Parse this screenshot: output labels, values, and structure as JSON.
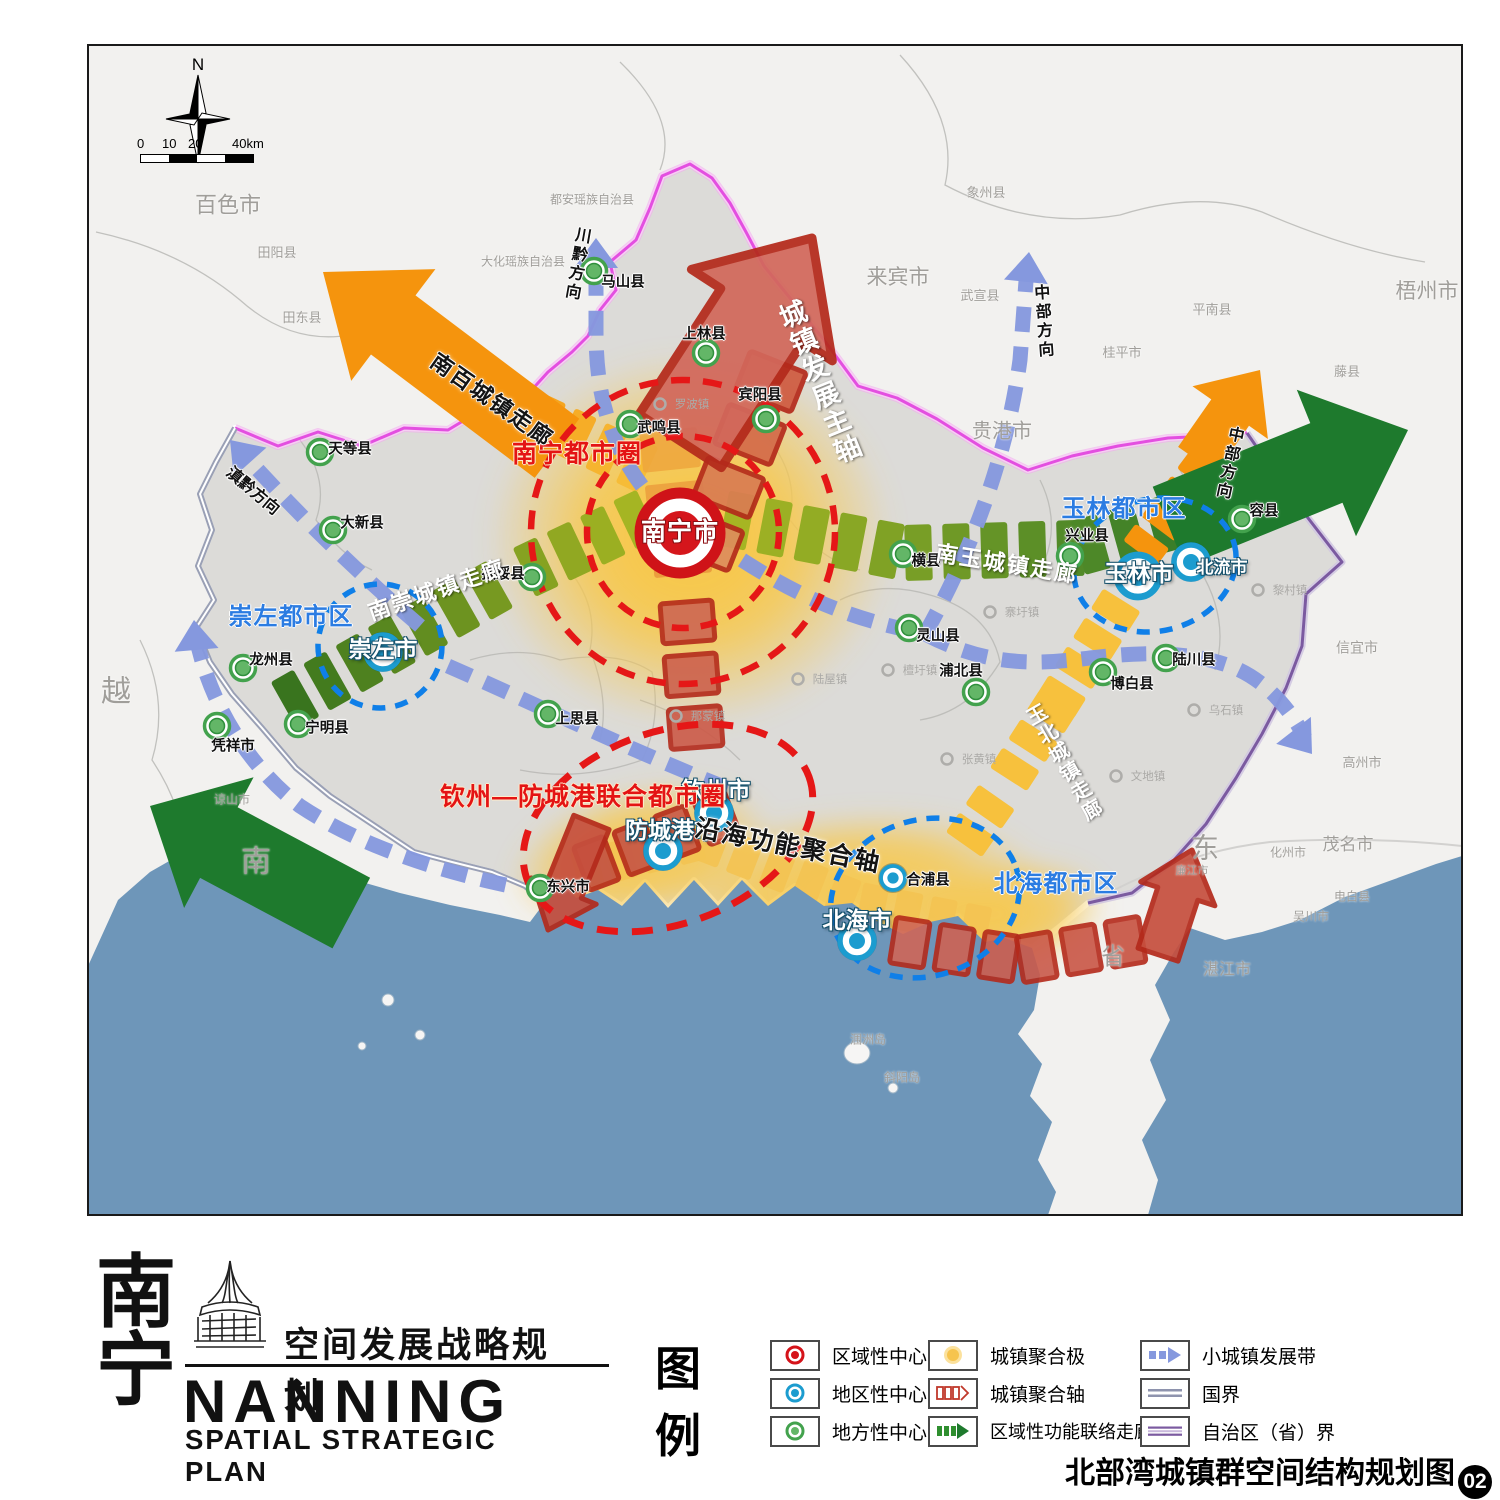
{
  "compass": {
    "label": "N"
  },
  "scalebar": {
    "ticks": [
      "0",
      "10",
      "20",
      "40km"
    ]
  },
  "title": {
    "cn_char_top": "南",
    "cn_char_bottom": "宁",
    "subtitle_cn": "空间发展战略规划",
    "name_en": "NANNING",
    "subtitle_en": "SPATIAL STRATEGIC PLAN"
  },
  "legend": {
    "heading_top": "图",
    "heading_bottom": "例",
    "columns": [
      [
        {
          "icon": "center-regional",
          "label": "区域性中心"
        },
        {
          "icon": "center-district",
          "label": "地区性中心"
        },
        {
          "icon": "center-local",
          "label": "地方性中心"
        }
      ],
      [
        {
          "icon": "agg-pole",
          "label": "城镇聚合极"
        },
        {
          "icon": "agg-axis",
          "label": "城镇聚合轴"
        },
        {
          "icon": "regional-corridor",
          "label": "区域性功能联络走廊"
        }
      ],
      [
        {
          "icon": "town-belt",
          "label": "小城镇发展带"
        },
        {
          "icon": "national-border",
          "label": "国界"
        },
        {
          "icon": "province-border",
          "label": "自治区（省）界"
        }
      ]
    ]
  },
  "caption": {
    "text": "北部湾城镇群空间结构规划图",
    "number": "02"
  },
  "map": {
    "cities": [
      {
        "label": "南宁市",
        "type": "regional",
        "mx": 680,
        "my": 533,
        "lx": 680,
        "ly": 532
      },
      {
        "label": "崇左市",
        "type": "district",
        "mx": 383,
        "my": 652,
        "lx": 383,
        "ly": 649
      },
      {
        "label": "玉林市",
        "type": "district-lg",
        "mx": 1138,
        "my": 576,
        "lx": 1139,
        "ly": 573
      },
      {
        "label": "北流市",
        "type": "district",
        "mx": 1191,
        "my": 562,
        "lx": 1222,
        "ly": 568,
        "lsize": 17
      },
      {
        "label": "钦州市",
        "type": "district",
        "mx": 714,
        "my": 813,
        "lx": 716,
        "ly": 790
      },
      {
        "label": "防城港市",
        "type": "district",
        "mx": 663,
        "my": 851,
        "lx": 671,
        "ly": 830
      },
      {
        "label": "北海市",
        "type": "district",
        "mx": 857,
        "my": 941,
        "lx": 857,
        "ly": 920
      },
      {
        "label": "合浦县",
        "type": "district-sm",
        "mx": 893,
        "my": 878,
        "lx": 928,
        "ly": 881
      }
    ],
    "locals": [
      {
        "label": "天等县",
        "mx": 320,
        "my": 452,
        "lx": 350,
        "ly": 450
      },
      {
        "label": "大新县",
        "mx": 333,
        "my": 530,
        "lx": 362,
        "ly": 524
      },
      {
        "label": "龙州县",
        "mx": 243,
        "my": 668,
        "lx": 271,
        "ly": 661
      },
      {
        "label": "宁明县",
        "mx": 298,
        "my": 724,
        "lx": 327,
        "ly": 729
      },
      {
        "label": "凭祥市",
        "mx": 217,
        "my": 726,
        "lx": 233,
        "ly": 747
      },
      {
        "label": "扶绥县",
        "mx": 532,
        "my": 577,
        "lx": 503,
        "ly": 575
      },
      {
        "label": "上思县",
        "mx": 548,
        "my": 714,
        "lx": 577,
        "ly": 720
      },
      {
        "label": "东兴市",
        "mx": 540,
        "my": 888,
        "lx": 568,
        "ly": 888
      },
      {
        "label": "武鸣县",
        "mx": 630,
        "my": 424,
        "lx": 659,
        "ly": 429
      },
      {
        "label": "马山县",
        "mx": 594,
        "my": 271,
        "lx": 623,
        "ly": 283
      },
      {
        "label": "上林县",
        "mx": 706,
        "my": 353,
        "lx": 704,
        "ly": 335
      },
      {
        "label": "宾阳县",
        "mx": 766,
        "my": 419,
        "lx": 760,
        "ly": 396
      },
      {
        "label": "横县",
        "mx": 903,
        "my": 554,
        "lx": 926,
        "ly": 562
      },
      {
        "label": "灵山县",
        "mx": 909,
        "my": 628,
        "lx": 938,
        "ly": 637
      },
      {
        "label": "浦北县",
        "mx": 976,
        "my": 692,
        "lx": 961,
        "ly": 672
      },
      {
        "label": "博白县",
        "mx": 1103,
        "my": 672,
        "lx": 1132,
        "ly": 685
      },
      {
        "label": "陆川县",
        "mx": 1166,
        "my": 658,
        "lx": 1194,
        "ly": 661
      },
      {
        "label": "兴业县",
        "mx": 1070,
        "my": 556,
        "lx": 1087,
        "ly": 537
      },
      {
        "label": "容县",
        "mx": 1242,
        "my": 519,
        "lx": 1264,
        "ly": 512
      }
    ],
    "metros": [
      {
        "label": "南宁都市圈",
        "x": 577,
        "y": 454,
        "color": "red"
      },
      {
        "label": "钦州—防城港联合都市圈",
        "x": 583,
        "y": 797,
        "color": "red"
      },
      {
        "label": "崇左都市区",
        "x": 291,
        "y": 617,
        "color": "blue"
      },
      {
        "label": "玉林都市区",
        "x": 1124,
        "y": 509,
        "color": "blue"
      },
      {
        "label": "北海都市区",
        "x": 1056,
        "y": 884,
        "color": "blue"
      }
    ],
    "corridors": [
      {
        "label": "南百城镇走廊",
        "x": 492,
        "y": 400,
        "rot": 35,
        "cls": "black",
        "size": 22,
        "vertical": false
      },
      {
        "label": "南崇城镇走廊",
        "x": 437,
        "y": 590,
        "rot": -19,
        "cls": "white",
        "size": 22,
        "vertical": false
      },
      {
        "label": "南玉城镇走廊",
        "x": 1007,
        "y": 564,
        "rot": 9,
        "cls": "white",
        "size": 22,
        "vertical": false
      },
      {
        "label": "玉北城镇走廊",
        "x": 1062,
        "y": 764,
        "rot": -30,
        "cls": "white",
        "size": 20,
        "vertical": true
      },
      {
        "label": "沿海功能聚合轴",
        "x": 788,
        "y": 846,
        "rot": 11,
        "cls": "black",
        "size": 25,
        "vertical": false
      },
      {
        "label": "城镇发展主轴",
        "x": 818,
        "y": 383,
        "rot": -22,
        "cls": "white",
        "size": 27,
        "vertical": true
      }
    ],
    "directions": [
      {
        "label": "川黔方向",
        "x": 575,
        "y": 264,
        "rot": 10,
        "vertical": true
      },
      {
        "label": "中部方向",
        "x": 1041,
        "y": 322,
        "rot": -4,
        "vertical": true
      },
      {
        "label": "中部方向",
        "x": 1227,
        "y": 463,
        "rot": 12,
        "vertical": true
      },
      {
        "label": "滇黔方向",
        "x": 252,
        "y": 492,
        "rot": 40,
        "vertical": false
      }
    ],
    "grays": [
      {
        "label": "百色市",
        "x": 228,
        "y": 205,
        "size": 22
      },
      {
        "label": "田阳县",
        "x": 277,
        "y": 253,
        "size": 13
      },
      {
        "label": "田东县",
        "x": 302,
        "y": 318,
        "size": 13
      },
      {
        "label": "大化瑶族自治县",
        "x": 523,
        "y": 262,
        "size": 12
      },
      {
        "label": "都安瑶族自治县",
        "x": 592,
        "y": 200,
        "size": 12
      },
      {
        "label": "来宾市",
        "x": 898,
        "y": 278,
        "size": 21
      },
      {
        "label": "象州县",
        "x": 986,
        "y": 193,
        "size": 13
      },
      {
        "label": "武宣县",
        "x": 980,
        "y": 296,
        "size": 13
      },
      {
        "label": "桂平市",
        "x": 1122,
        "y": 353,
        "size": 13
      },
      {
        "label": "贵港市",
        "x": 1002,
        "y": 432,
        "size": 20
      },
      {
        "label": "平南县",
        "x": 1212,
        "y": 310,
        "size": 13
      },
      {
        "label": "梧州市",
        "x": 1427,
        "y": 292,
        "size": 21
      },
      {
        "label": "藤县",
        "x": 1347,
        "y": 372,
        "size": 13
      },
      {
        "label": "信宜市",
        "x": 1357,
        "y": 648,
        "size": 14
      },
      {
        "label": "高州市",
        "x": 1362,
        "y": 763,
        "size": 13
      },
      {
        "label": "茂名市",
        "x": 1348,
        "y": 845,
        "size": 17
      },
      {
        "label": "化州市",
        "x": 1288,
        "y": 853,
        "size": 12
      },
      {
        "label": "电白县",
        "x": 1352,
        "y": 897,
        "size": 12
      },
      {
        "label": "吴川市",
        "x": 1311,
        "y": 917,
        "size": 12
      },
      {
        "label": "湛江市",
        "x": 1227,
        "y": 971,
        "size": 16
      },
      {
        "label": "廉江市",
        "x": 1192,
        "y": 872,
        "size": 11
      },
      {
        "label": "东",
        "x": 1205,
        "y": 848,
        "size": 28
      },
      {
        "label": "省",
        "x": 1113,
        "y": 957,
        "size": 24
      },
      {
        "label": "越",
        "x": 116,
        "y": 692,
        "size": 30
      },
      {
        "label": "南",
        "x": 256,
        "y": 862,
        "size": 30
      },
      {
        "label": "谅山市",
        "x": 232,
        "y": 800,
        "size": 12
      },
      {
        "label": "涠洲岛",
        "x": 868,
        "y": 1040,
        "size": 12
      },
      {
        "label": "斜阳岛",
        "x": 902,
        "y": 1078,
        "size": 12
      }
    ],
    "towns": [
      {
        "label": "罗波镇",
        "cx": 660,
        "cy": 404
      },
      {
        "label": "寨圩镇",
        "cx": 990,
        "cy": 612
      },
      {
        "label": "檀圩镇",
        "cx": 888,
        "cy": 670
      },
      {
        "label": "张黄镇",
        "cx": 947,
        "cy": 759
      },
      {
        "label": "那蒙镇",
        "cx": 676,
        "cy": 716
      },
      {
        "label": "陆屋镇",
        "cx": 798,
        "cy": 679
      },
      {
        "label": "文地镇",
        "cx": 1116,
        "cy": 776
      },
      {
        "label": "黎村镇",
        "cx": 1258,
        "cy": 590
      },
      {
        "label": "乌石镇",
        "cx": 1194,
        "cy": 710
      }
    ],
    "colors": {
      "sea": "#6e96b9",
      "land": "#f2f1ef",
      "region": "#dcdbd8",
      "orange": "#f5940d",
      "dark_green": "#1e7a2d",
      "olive": "#a9b723",
      "gold": "#f7c13d",
      "red_axis": "#c94634",
      "red_dash": "#e51717",
      "blue_dash_band": "#8598de",
      "blue_metro": "#0f7fe8",
      "magenta_border": "#e34fe0",
      "purple_border": "#7b5aa0"
    }
  }
}
